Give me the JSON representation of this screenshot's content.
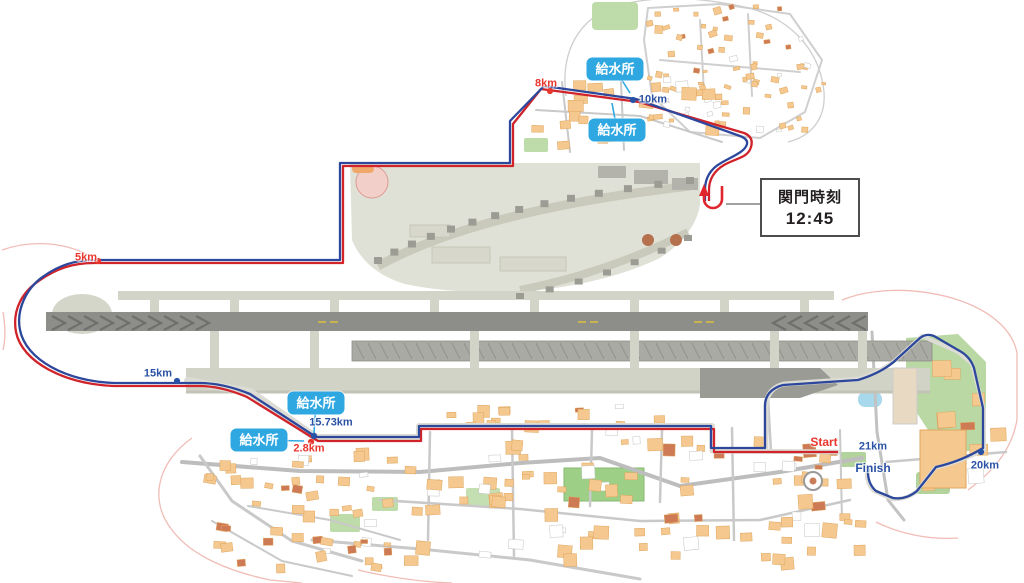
{
  "map_title": "Airport half-marathon course map",
  "checkpoint": {
    "line1": "関門時刻",
    "line2": "12:45"
  },
  "water_station_label": "給水所",
  "water_stations": [
    {
      "label": "給水所",
      "x": 615,
      "y": 69,
      "tx": 630,
      "ty": 93
    },
    {
      "label": "給水所",
      "x": 617,
      "y": 130,
      "tx": 612,
      "ty": 103
    },
    {
      "label": "給水所",
      "x": 316,
      "y": 403,
      "tx": 314,
      "ty": 433
    },
    {
      "label": "給水所",
      "x": 259,
      "y": 440,
      "tx": 304,
      "ty": 441
    }
  ],
  "km_markers": [
    {
      "label": "5km",
      "color": "red",
      "x": 86,
      "y": 258,
      "dot": [
        98,
        261
      ]
    },
    {
      "label": "8km",
      "color": "red",
      "x": 546,
      "y": 84,
      "dot": [
        550,
        91
      ]
    },
    {
      "label": "10km",
      "color": "blue",
      "x": 653,
      "y": 100,
      "dot": [
        633,
        100
      ]
    },
    {
      "label": "15km",
      "color": "blue",
      "x": 158,
      "y": 374,
      "dot": [
        177,
        381
      ]
    },
    {
      "label": "15.73km",
      "color": "blue",
      "x": 331,
      "y": 423,
      "dot": [
        314,
        436
      ]
    },
    {
      "label": "2.8km",
      "color": "red",
      "x": 309,
      "y": 449,
      "dot": [
        311,
        442
      ]
    },
    {
      "label": "Start",
      "color": "red",
      "x": 824,
      "y": 442,
      "dot": null,
      "big": true
    },
    {
      "label": "21km",
      "color": "blue",
      "x": 873,
      "y": 447,
      "dot": null
    },
    {
      "label": "Finish",
      "color": "blue",
      "x": 873,
      "y": 468,
      "dot": null,
      "big": true
    },
    {
      "label": "20km",
      "color": "blue",
      "x": 985,
      "y": 466,
      "dot": [
        981,
        452
      ]
    }
  ],
  "colors": {
    "course_red": "#d0232a",
    "course_blue": "#2c479c",
    "marker_red": "#e8362d",
    "marker_blue": "#2a52a4",
    "water_station_bg": "#2fa8e1",
    "runway": "#8d8d89",
    "building": "#f4c88e",
    "park": "#b9d8a4"
  }
}
